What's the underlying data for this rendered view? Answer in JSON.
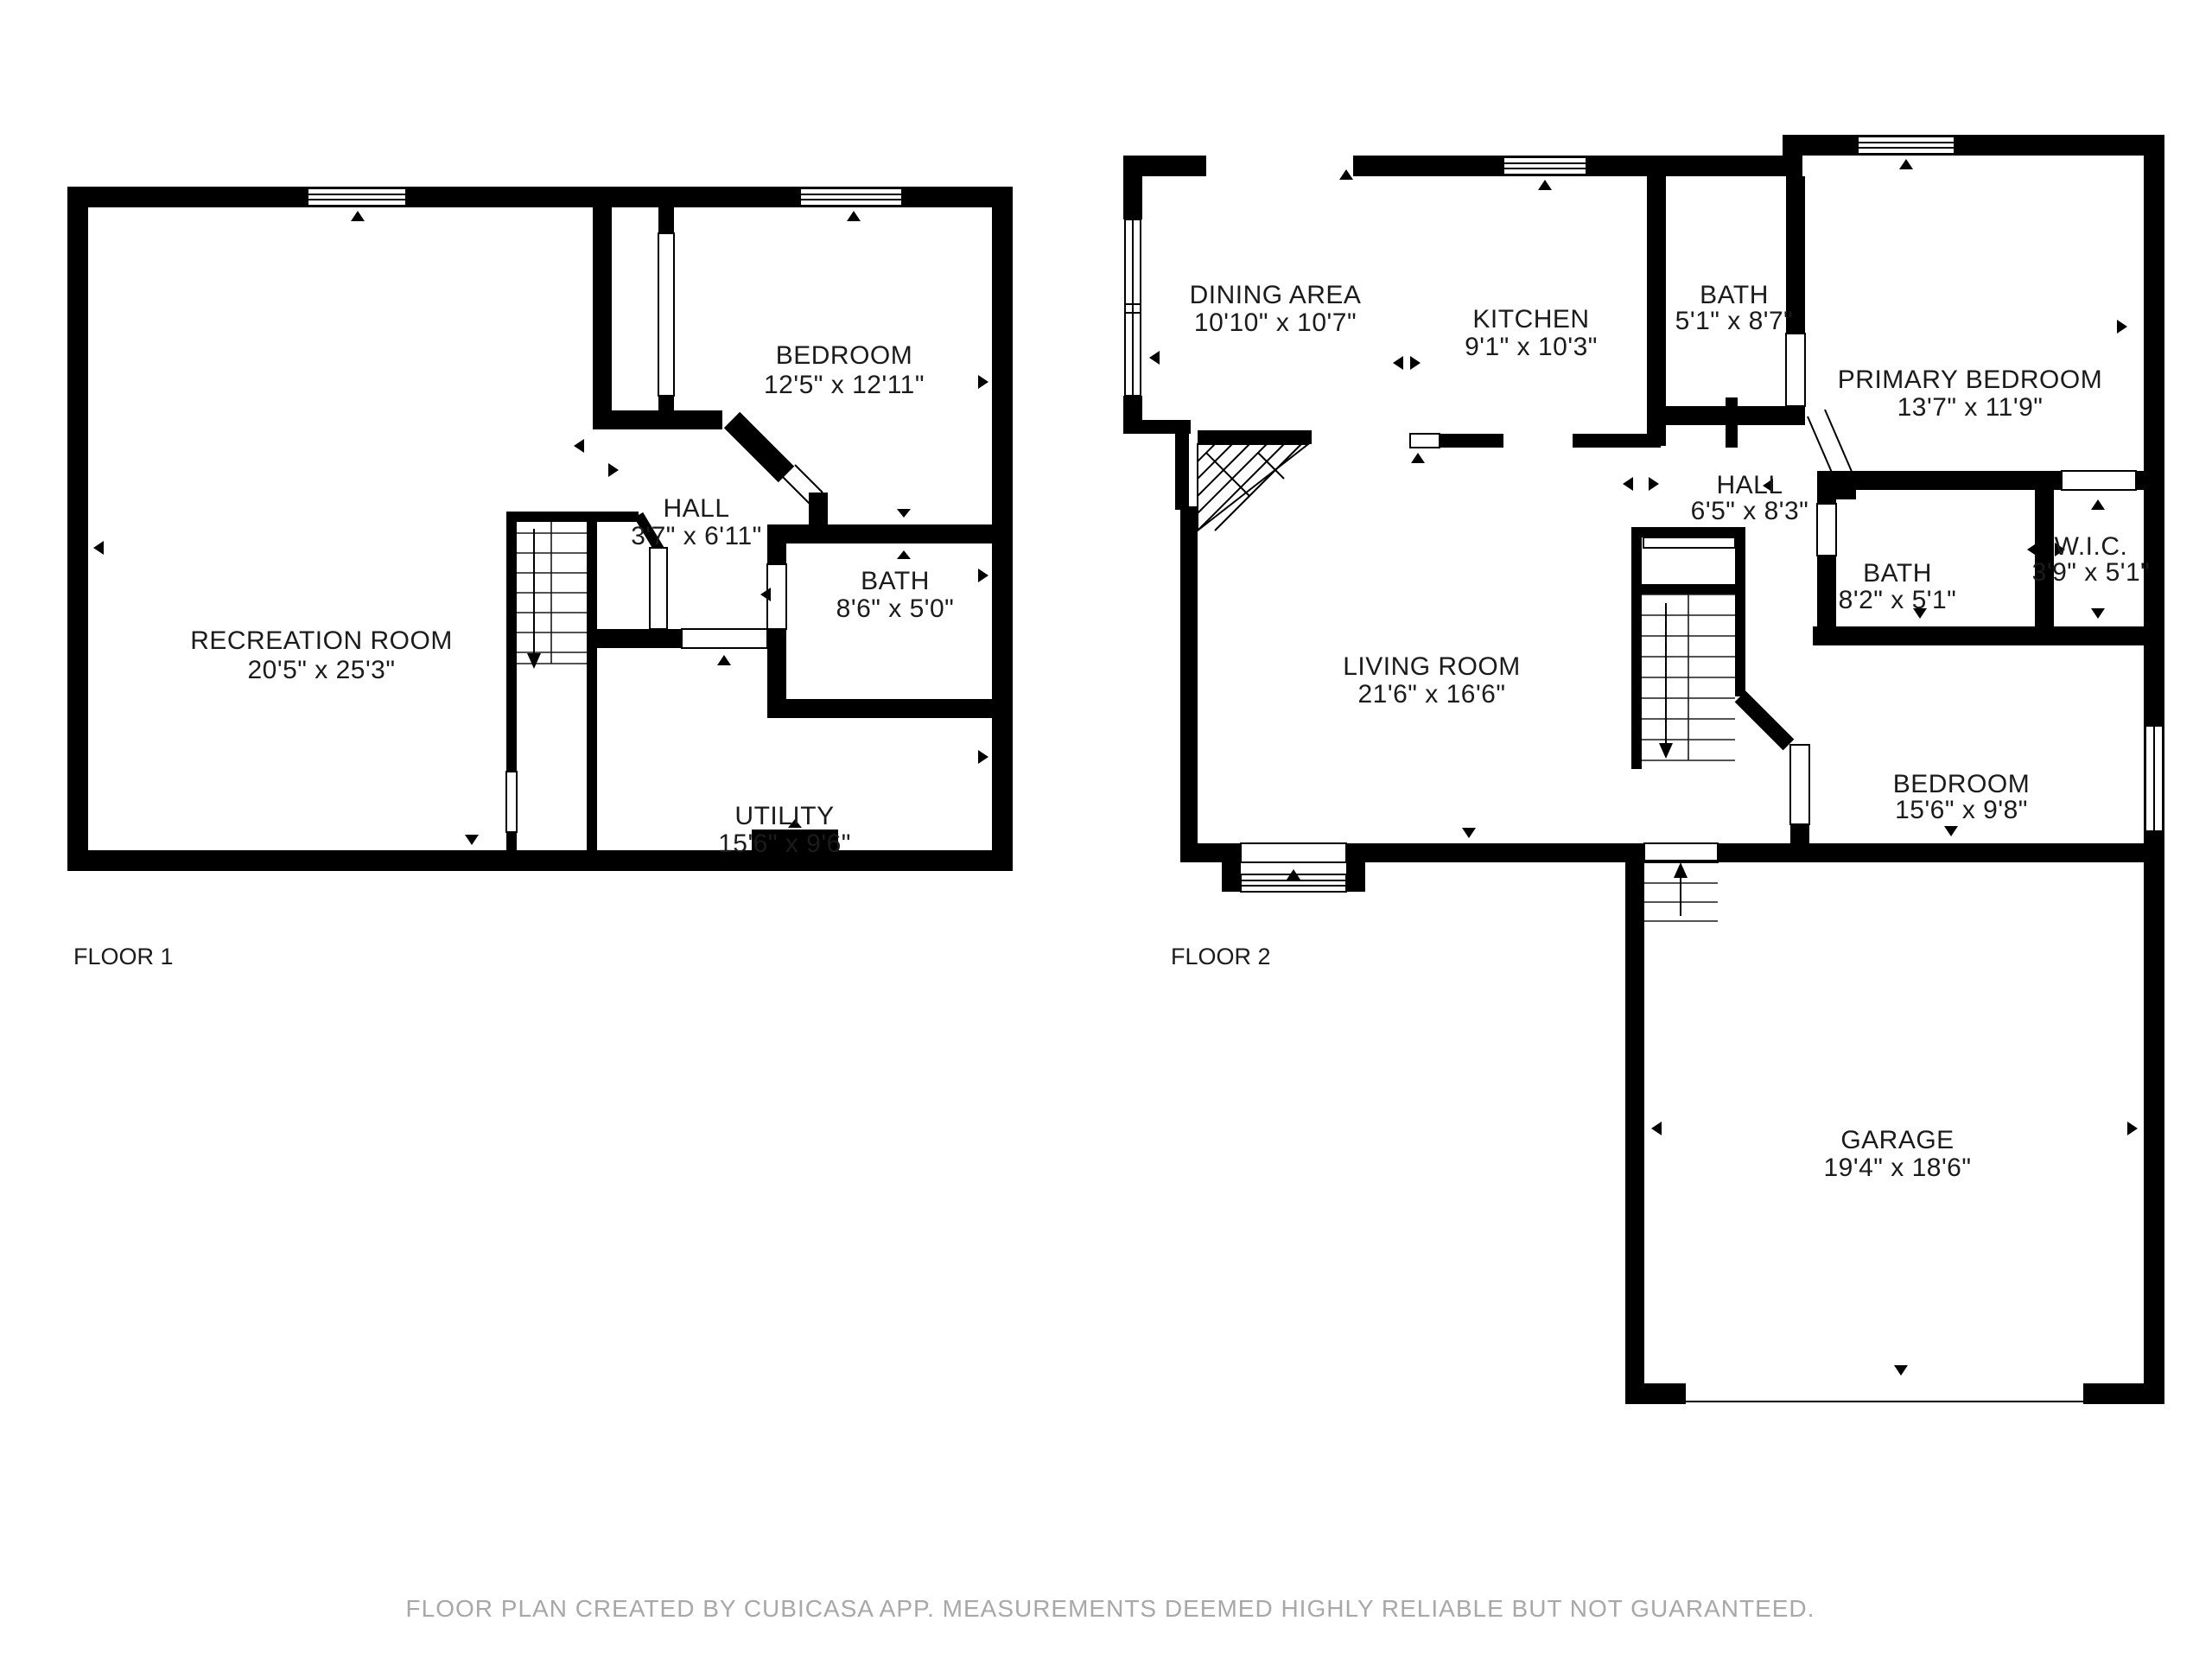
{
  "caption": "FLOOR PLAN CREATED BY CUBICASA APP. MEASUREMENTS DEEMED HIGHLY RELIABLE BUT NOT GUARANTEED.",
  "colors": {
    "wall": "#000000",
    "text": "#1b1b1b",
    "caption_gray": "#a8a8a8",
    "background": "#ffffff"
  },
  "floor1": {
    "label": "FLOOR 1",
    "rooms": [
      {
        "name": "RECREATION ROOM",
        "dims": "20'5\" x 25'3\""
      },
      {
        "name": "BEDROOM",
        "dims": "12'5\" x 12'11\""
      },
      {
        "name": "HALL",
        "dims": "3'7\" x 6'11\""
      },
      {
        "name": "BATH",
        "dims": "8'6\" x 5'0\""
      },
      {
        "name": "UTILITY",
        "dims": "15'6\" x 9'6\""
      }
    ]
  },
  "floor2": {
    "label": "FLOOR 2",
    "rooms": [
      {
        "name": "DINING AREA",
        "dims": "10'10\" x 10'7\""
      },
      {
        "name": "KITCHEN",
        "dims": "9'1\" x 10'3\""
      },
      {
        "name": "BATH",
        "dims": "5'1\" x 8'7\""
      },
      {
        "name": "PRIMARY BEDROOM",
        "dims": "13'7\" x 11'9\""
      },
      {
        "name": "HALL",
        "dims": "6'5\" x 8'3\""
      },
      {
        "name": "BATH",
        "dims": "8'2\" x 5'1\""
      },
      {
        "name": "W.I.C.",
        "dims": "3'9\" x 5'1\""
      },
      {
        "name": "BEDROOM",
        "dims": "15'6\" x 9'8\""
      },
      {
        "name": "LIVING ROOM",
        "dims": "21'6\" x 16'6\""
      },
      {
        "name": "GARAGE",
        "dims": "19'4\" x 18'6\""
      }
    ]
  }
}
